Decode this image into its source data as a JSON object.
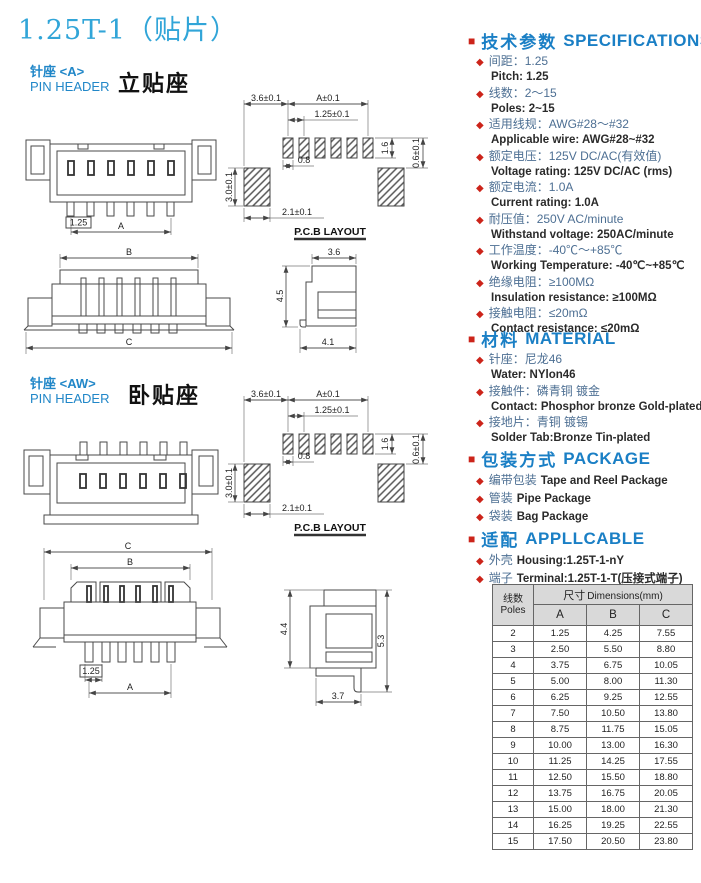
{
  "page_title": "1.25T-1（贴片）",
  "glyphs": {
    "square": "■",
    "diamond": "◆"
  },
  "colors": {
    "title_blue": "#31a5d8",
    "heading_blue": "#1a7fc5",
    "bullet_red": "#cc241a",
    "label_blue": "#2187c8",
    "zh_text": "#4d6f93"
  },
  "section_a": {
    "zh": "针座 <A>",
    "en": "PIN HEADER",
    "type_label": "立贴座"
  },
  "section_aw": {
    "zh": "针座 <AW>",
    "en": "PIN HEADER",
    "type_label": "卧贴座"
  },
  "drawings": {
    "pcb": {
      "dim_top_left": "3.6±0.1",
      "dim_top": "A±0.1",
      "dim_pitch": "1.25±0.1",
      "dim_pad_width": "0.8",
      "dim_pad_height": "1.6",
      "dim_offset": "0.6±0.1",
      "dim_side_pad": "3.0±0.1",
      "dim_side_pad_width": "2.1±0.1",
      "caption": "P.C.B LAYOUT"
    },
    "front_a": {
      "dim_pitch": "1.25",
      "dim_span": "A"
    },
    "top_a": {
      "dim_b": "B",
      "dim_c": "C"
    },
    "side_a": {
      "dim_width": "3.6",
      "dim_height": "4.5",
      "dim_base": "4.1"
    },
    "top_aw": {
      "dim_c": "C",
      "dim_b": "B",
      "dim_pitch": "1.25",
      "dim_a": "A"
    },
    "side_aw": {
      "dim_height1": "4.4",
      "dim_height2": "5.3",
      "dim_base": "3.7"
    }
  },
  "specifications": {
    "title_zh": "技术参数",
    "title_en": "SPECIFICATIONS",
    "items": [
      {
        "zh": "间距：1.25",
        "en": "Pitch: 1.25"
      },
      {
        "zh": "线数：2～15",
        "en": "Poles: 2~15"
      },
      {
        "zh": "适用线规：AWG#28～#32",
        "en": "Applicable wire: AWG#28~#32"
      },
      {
        "zh": "额定电压：125V DC/AC(有效值)",
        "en": "Voltage rating: 125V DC/AC (rms)"
      },
      {
        "zh": "额定电流：1.0A",
        "en": "Current rating: 1.0A"
      },
      {
        "zh": "耐压值：250V AC/minute",
        "en": "Withstand voltage: 250AC/minute"
      },
      {
        "zh": "工作温度：-40℃～+85℃",
        "en": "Working Temperature: -40℃~+85℃"
      },
      {
        "zh": "绝缘电阻：≥100MΩ",
        "en": "Insulation resistance: ≥100MΩ"
      },
      {
        "zh": "接触电阻：≤20mΩ",
        "en": "Contact resistance: ≤20mΩ"
      }
    ]
  },
  "material": {
    "title_zh": "材料",
    "title_en": "MATERIAL",
    "items": [
      {
        "zh": "针座：尼龙46",
        "en": "Water:  NYlon46"
      },
      {
        "zh": "接触件：磷青铜 镀金",
        "en": "Contact:  Phosphor bronze Gold-plated"
      },
      {
        "zh": "接地片：青铜 镀锡",
        "en": "Solder Tab:Bronze Tin-plated"
      }
    ]
  },
  "package": {
    "title_zh": "包装方式",
    "title_en": "PACKAGE",
    "items": [
      {
        "zh": "编带包装",
        "en": "Tape and Reel Package"
      },
      {
        "zh": "管装",
        "en": "Pipe Package"
      },
      {
        "zh": "袋装",
        "en": "Bag Package"
      }
    ]
  },
  "applicable": {
    "title_zh": "适配",
    "title_en": "APPLLCABLE",
    "items": [
      {
        "zh": "外壳",
        "en": "Housing:1.25T-1-nY"
      },
      {
        "zh": "端子",
        "en": "Terminal:1.25T-1-T(压接式端子)"
      }
    ]
  },
  "table": {
    "header": {
      "poles_zh": "线数",
      "poles_en": "Poles",
      "dims_zh": "尺寸",
      "dims_en": "Dimensions(mm)",
      "col_a": "A",
      "col_b": "B",
      "col_c": "C"
    },
    "rows": [
      {
        "poles": "2",
        "a": "1.25",
        "b": "4.25",
        "c": "7.55"
      },
      {
        "poles": "3",
        "a": "2.50",
        "b": "5.50",
        "c": "8.80"
      },
      {
        "poles": "4",
        "a": "3.75",
        "b": "6.75",
        "c": "10.05"
      },
      {
        "poles": "5",
        "a": "5.00",
        "b": "8.00",
        "c": "11.30"
      },
      {
        "poles": "6",
        "a": "6.25",
        "b": "9.25",
        "c": "12.55"
      },
      {
        "poles": "7",
        "a": "7.50",
        "b": "10.50",
        "c": "13.80"
      },
      {
        "poles": "8",
        "a": "8.75",
        "b": "11.75",
        "c": "15.05"
      },
      {
        "poles": "9",
        "a": "10.00",
        "b": "13.00",
        "c": "16.30"
      },
      {
        "poles": "10",
        "a": "11.25",
        "b": "14.25",
        "c": "17.55"
      },
      {
        "poles": "11",
        "a": "12.50",
        "b": "15.50",
        "c": "18.80"
      },
      {
        "poles": "12",
        "a": "13.75",
        "b": "16.75",
        "c": "20.05"
      },
      {
        "poles": "13",
        "a": "15.00",
        "b": "18.00",
        "c": "21.30"
      },
      {
        "poles": "14",
        "a": "16.25",
        "b": "19.25",
        "c": "22.55"
      },
      {
        "poles": "15",
        "a": "17.50",
        "b": "20.50",
        "c": "23.80"
      }
    ]
  }
}
